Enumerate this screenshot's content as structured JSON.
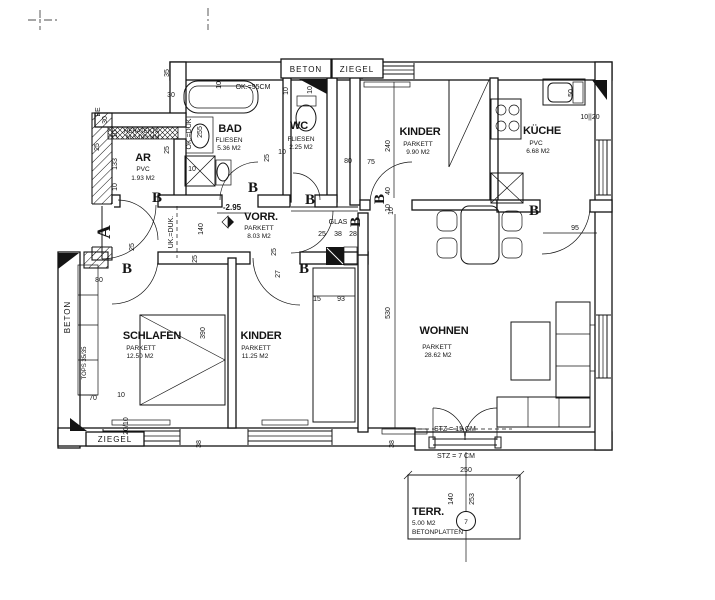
{
  "drawing": {
    "rooms": [
      {
        "name": "AR",
        "floor": "PVC",
        "area": "1.93 M2"
      },
      {
        "name": "BAD",
        "floor": "FLIESEN",
        "area": "5.36 M2"
      },
      {
        "name": "WC",
        "floor": "FLIESEN",
        "area": "2.25 M2"
      },
      {
        "name": "VORR.",
        "floor": "PARKETT",
        "area": "8.03 M2"
      },
      {
        "name": "KINDER",
        "floor": "PARKETT",
        "area": "9.90 M2"
      },
      {
        "name": "KÜCHE",
        "floor": "PVC",
        "area": "6.68 M2"
      },
      {
        "name": "SCHLAFEN",
        "floor": "PARKETT",
        "area": "12.50 M2"
      },
      {
        "name": "KINDER",
        "floor": "PARKETT",
        "area": "11.25 M2"
      },
      {
        "name": "WOHNEN",
        "floor": "PARKETT",
        "area": "28.62 M2"
      },
      {
        "name": "TERR.",
        "floor": "BETONPLATTEN",
        "area": "5.00 M2"
      }
    ],
    "terrace_number": "7",
    "door_labels": {
      "entrance": "A",
      "standard": "B"
    },
    "wall_labels": {
      "beton": "BETON",
      "ziegel": "ZIEGEL",
      "be": "BE",
      "tops": "TOPS 35/35",
      "heratekta_1": "HERATEKTA",
      "heratekta_2": "M 3  100 MM"
    },
    "annotations": {
      "tub_height": "OK.=95CM",
      "ok_duk": "OK.=DUK",
      "uk_duk": "UK.=DUK.",
      "level": "-2.95",
      "glas": "GLAS",
      "stz15": "STZ = 15 CM",
      "stz7": "STZ = 7 CM"
    },
    "dims": [
      "35",
      "30",
      "30",
      "10",
      "25",
      "133",
      "10",
      "25",
      "10",
      "255",
      "10",
      "25",
      "10",
      "10",
      "10",
      "140",
      "80",
      "75",
      "40",
      "10",
      "240",
      "50",
      "10||20",
      "95",
      "25",
      "38",
      "28",
      "15",
      "93",
      "25",
      "27",
      "80",
      "25",
      "390",
      "25",
      "70",
      "10",
      "20/10",
      "38",
      "38",
      "530",
      "250",
      "140",
      "253",
      "10"
    ]
  }
}
